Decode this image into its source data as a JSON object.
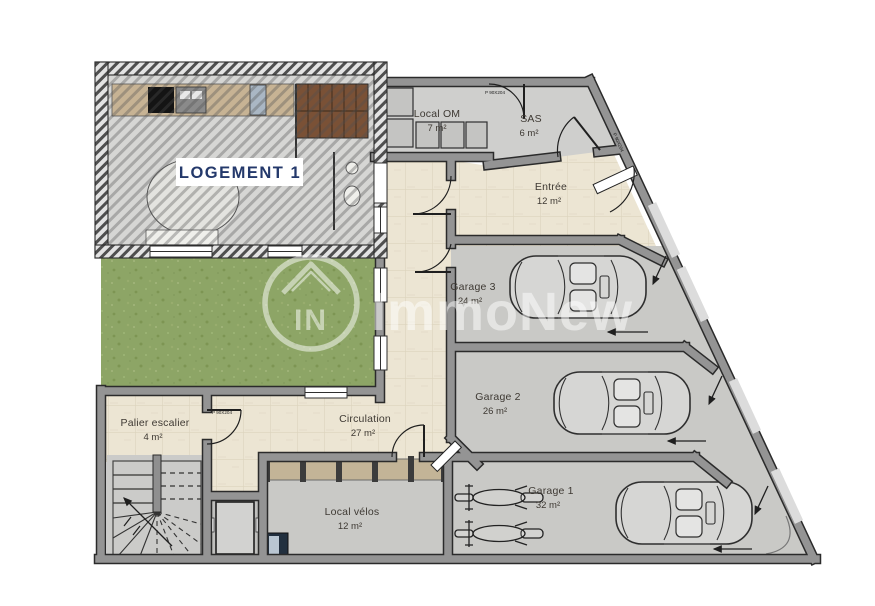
{
  "plan": {
    "unit_label": "LOGEMENT 1",
    "rooms": [
      {
        "name": "Local OM",
        "area": "7 m²"
      },
      {
        "name": "SAS",
        "area": "6 m²"
      },
      {
        "name": "Entrée",
        "area": "12 m²"
      },
      {
        "name": "Garage 3",
        "area": "24 m²"
      },
      {
        "name": "Garage 2",
        "area": "26 m²"
      },
      {
        "name": "Garage 1",
        "area": "32 m²"
      },
      {
        "name": "Palier escalier",
        "area": "4 m²"
      },
      {
        "name": "Circulation",
        "area": "27 m²"
      },
      {
        "name": "Local vélos",
        "area": "12 m²"
      }
    ],
    "door_label": "P 90X204",
    "watermark": {
      "brand": "ImmoNew",
      "logo_initials": "IN"
    }
  },
  "colors": {
    "wall": "#949494",
    "wall_outline": "#2b2b2b",
    "garage_floor": "#c9c9c6",
    "tile_floor": "#ece5d3",
    "garden": "#8da566",
    "logement_floor": "#d6d6d4",
    "label": "#3e3933",
    "unit_label": "#24396b",
    "kitchen_counter": "#c7b394",
    "stair_wood": "#7a5136",
    "bike_rack": "#c3b497",
    "watermark": "#ffffff"
  }
}
